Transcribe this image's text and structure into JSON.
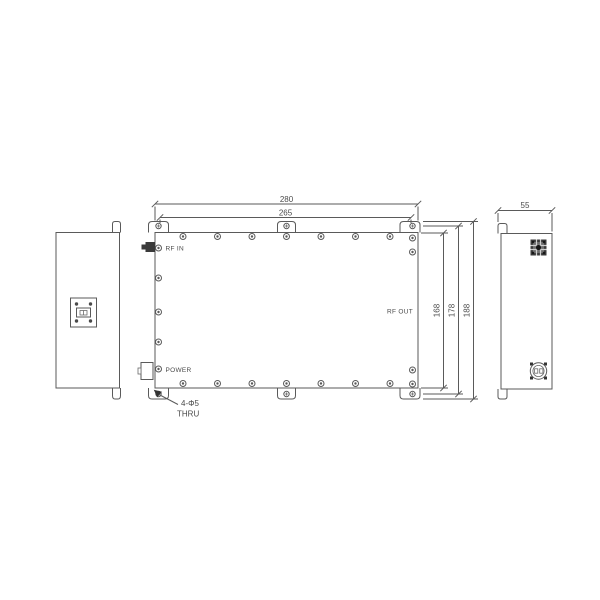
{
  "drawing": {
    "type": "mechanical-drawing",
    "views": {
      "front": {
        "label_rf_in": "RF IN",
        "label_power": "POWER",
        "label_rf_out": "RF OUT"
      },
      "note": {
        "line1": "4-Φ5",
        "line2": "THRU"
      }
    },
    "dimensions": {
      "overall_width": "280",
      "mount_hole_width": "265",
      "depth": "55",
      "body_height": "168",
      "mount_hole_height": "178",
      "overall_height": "188"
    },
    "icons": {
      "screw": "concentric-circle-screw",
      "tab_hole": "cross-marked-hole",
      "rf_in_connector": "filled-coax-connector",
      "power_connector": "rectangular-connector-outline",
      "waveguide_flange": "square-flange-4-holes",
      "rf_connector_face": "dark-square-connector-face",
      "power_connector_face": "round-4pin-connector-face",
      "leader_arrow": "filled-arrowhead"
    },
    "colors": {
      "background": "#ffffff",
      "line": "#5a5a5a",
      "text": "#4a4a4a",
      "connector_fill": "#3a3a3a"
    }
  }
}
